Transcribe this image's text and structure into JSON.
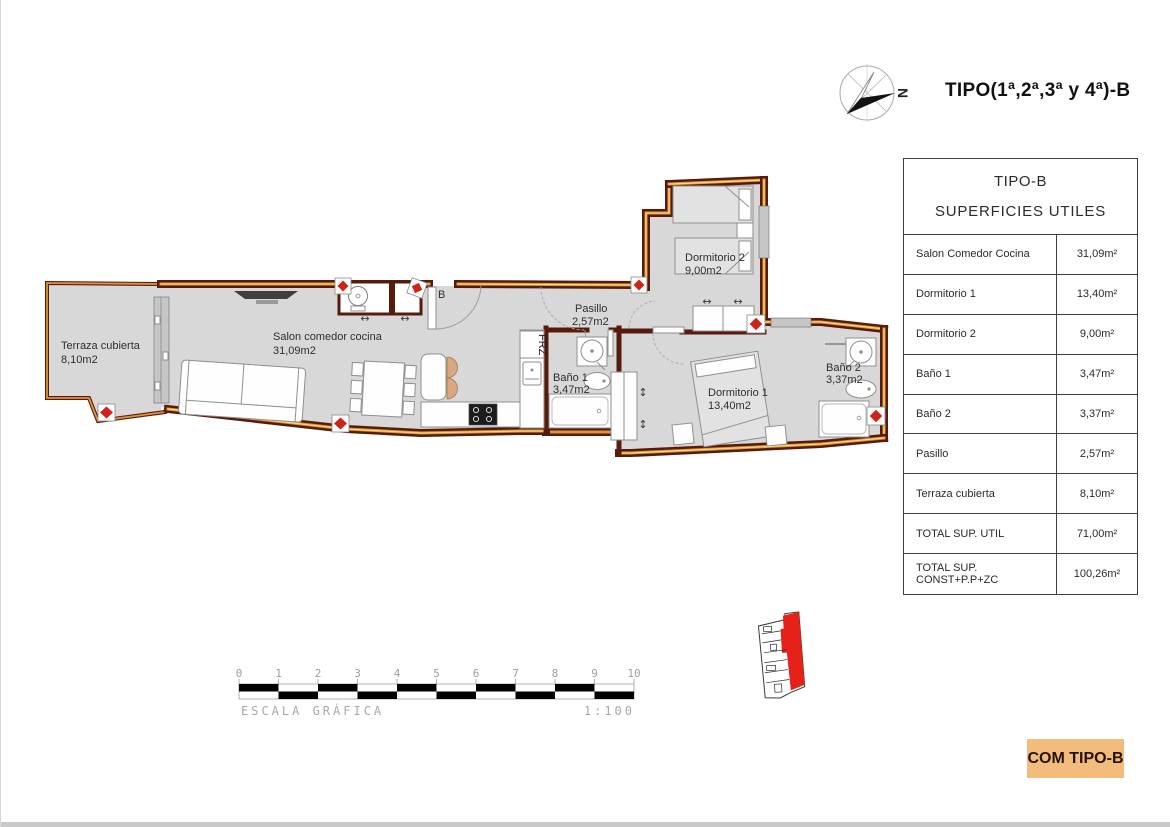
{
  "header": {
    "title": "TIPO(1ª,2ª,3ª y 4ª)-B",
    "compass_label": "N"
  },
  "summary_table": {
    "title_line1": "TIPO-B",
    "title_line2": "SUPERFICIES UTILES",
    "rows": [
      {
        "label": "Salon Comedor Cocina",
        "value": "31,09m²"
      },
      {
        "label": "Dormitorio 1",
        "value": "13,40m²"
      },
      {
        "label": "Dormitorio 2",
        "value": "9,00m²"
      },
      {
        "label": "Baño 1",
        "value": "3,47m²"
      },
      {
        "label": "Baño 2",
        "value": "3,37m²"
      },
      {
        "label": "Pasillo",
        "value": "2,57m²"
      },
      {
        "label": "Terraza cubierta",
        "value": "8,10m²"
      },
      {
        "label": "TOTAL SUP. UTIL",
        "value": "71,00m²"
      },
      {
        "label": "TOTAL SUP. CONST+P.P+ZC",
        "value": "100,26m²"
      }
    ]
  },
  "floor_plan": {
    "rooms": [
      {
        "name": "Terraza cubierta",
        "area": "8,10m2"
      },
      {
        "name": "Salon comedor cocina",
        "area": "31,09m2"
      },
      {
        "name": "Pasillo",
        "area": "2,57m2"
      },
      {
        "name": "Baño 1",
        "area": "3,47m2"
      },
      {
        "name": "Dormitorio 2",
        "area": "9,00m2"
      },
      {
        "name": "Dormitorio 1",
        "area": "13,40m2"
      },
      {
        "name": "Baño 2",
        "area": "3,37m2"
      }
    ],
    "entrance_label": "B",
    "fridge_label": "FRZ"
  },
  "scale_bar": {
    "ticks": [
      "0",
      "1",
      "2",
      "3",
      "4",
      "5",
      "6",
      "7",
      "8",
      "9",
      "10"
    ],
    "label": "ESCALA GRÁFICA",
    "ratio": "1:100"
  },
  "footer": {
    "type_label": "COM TIPO-B"
  },
  "colors": {
    "wall": "#571b0d",
    "wall_core_orange": "#e0923c",
    "wall_core_yellow": "#f6e387",
    "floor": "#d8d8d8",
    "pillar_red": "#ce2418",
    "key_plan_red": "#e62119",
    "footer_orange": "#f2bc7c"
  }
}
